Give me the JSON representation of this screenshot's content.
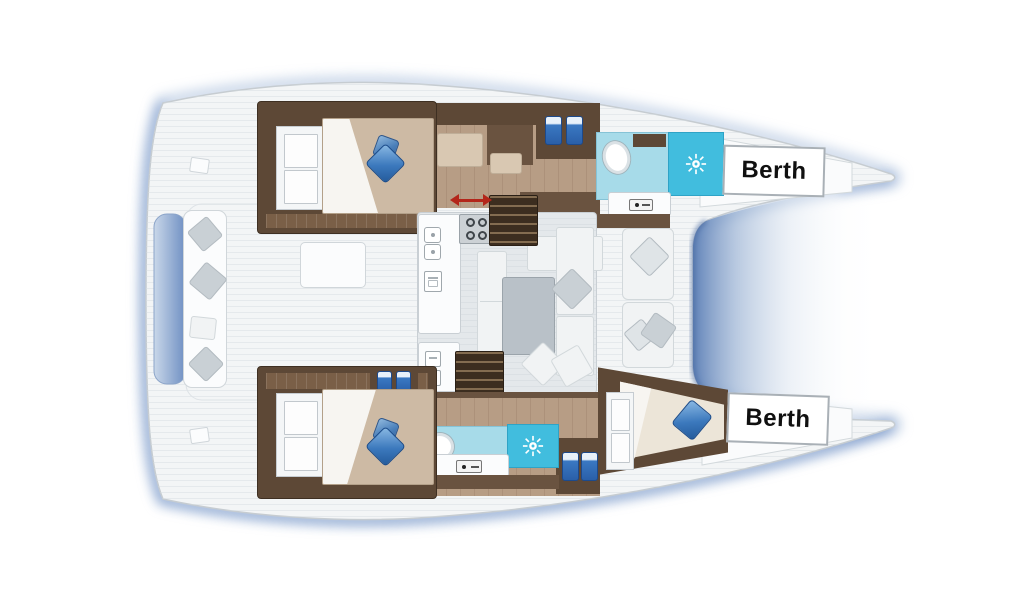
{
  "colors": {
    "deck": "#f3f5f6",
    "deck-line": "#c6ccd1",
    "plank": "#d6dde1",
    "glow": "#aabfdc",
    "shadow-deep": "#6b8cc4",
    "notch-deep": "#5c7fb6",
    "wood-dark": "#5d4836",
    "wood-mid": "#6a5340",
    "wood-floor": "#b79d85",
    "wood-strip": "#7a5f47",
    "mattress": "#cdbaa4",
    "sheet": "#f7f5f1",
    "pillow-blue": "#2f6fb4",
    "bath-floor": "#a7dbe9",
    "shower": "#41bdde",
    "salon-floor": "#e4e8eb",
    "sofa": "#f1f3f4",
    "cushion": "#c9d0d5",
    "table": "#b9c1c8",
    "stairs": "#3c2d1f",
    "arrow-red": "#b3261a",
    "jug": "#3a78c2",
    "seat-beige": "#d9c8b2",
    "label-border": "#a9b0b6",
    "label-text": "#101010"
  },
  "floorplan": {
    "type": "catamaran-floor-plan",
    "berths": [
      {
        "label": "Berth",
        "position": "upper-hull-bow"
      },
      {
        "label": "Berth",
        "position": "lower-hull-bow"
      }
    ],
    "icons": [
      "sun-icon",
      "toilet-icon",
      "sink-icon",
      "stove-icon",
      "faucet-icon",
      "sliding-door-arrow-icon",
      "pillow-icon",
      "bottle-icon",
      "companionway-stairs"
    ]
  }
}
